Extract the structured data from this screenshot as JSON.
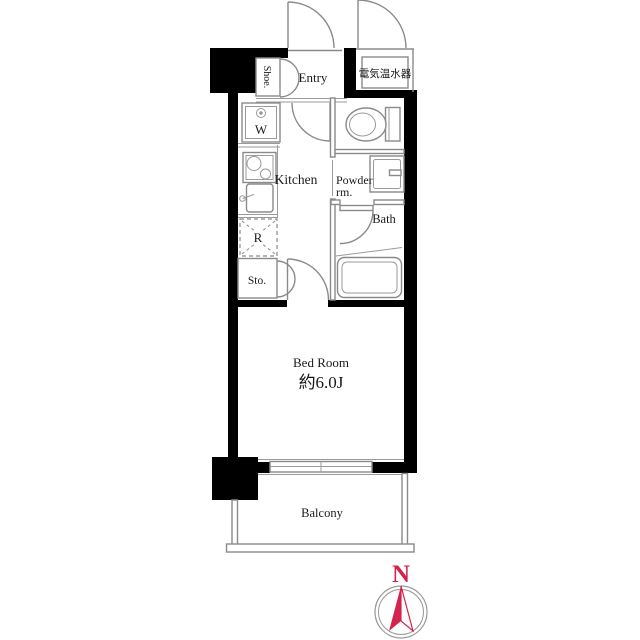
{
  "plan": {
    "labels": {
      "shoe": "Shoe.",
      "entry": "Entry",
      "water_heater": "電気温水器",
      "washer": "W",
      "kitchen": "Kitchen",
      "powder_line1": "Powder",
      "powder_line2": "rm.",
      "bath": "Bath",
      "refrigerator": "R",
      "storage": "Sto.",
      "bedroom": "Bed Room",
      "bedroom_size": "約6.0J",
      "balcony": "Balcony"
    },
    "compass": {
      "north": "N",
      "color": "#d4234c"
    },
    "colors": {
      "wall": "#000000",
      "line": "#8a8a8a",
      "text": "#1a1a1a",
      "background": "#ffffff"
    }
  }
}
